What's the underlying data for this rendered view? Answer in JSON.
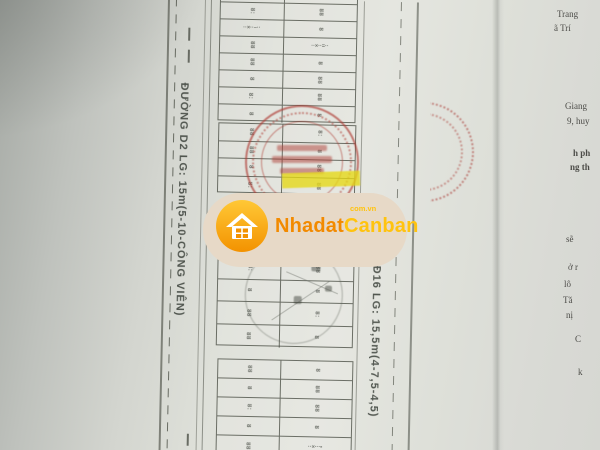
{
  "watermark": {
    "brand_part1": "Nhadat",
    "brand_part2": "Canban",
    "domain": "com.vn",
    "pill_color": "#e7d9c7",
    "orange": "#f28a00",
    "yellow": "#ffc30f"
  },
  "roads": {
    "left_label": "ĐƯỜNG D2 LG: 15m(5-10-CÔNG VIÊN)",
    "right_label": "ĐƯỜNG Đ16 LG: 15,5m(4-7,5-4,5)"
  },
  "plan": {
    "line_color": "rgba(72,76,66,0.78)",
    "marks": [
      "8",
      "88",
      "8:",
      "88",
      "8"
    ],
    "blocks": [
      {
        "left": 220,
        "top": -14,
        "width": 138,
        "rows": 8,
        "row_h": 17
      },
      {
        "left": 221,
        "top": 124,
        "width": 138,
        "rows": 4,
        "row_h": 17.5
      },
      {
        "left": 223,
        "top": 257,
        "width": 137,
        "rows": 4,
        "row_h": 22.5
      },
      {
        "left": 225,
        "top": 360,
        "width": 136,
        "rows": 5,
        "row_h": 19
      }
    ],
    "overrides": [
      {
        "b": 0,
        "r": 2,
        "c": 0,
        "t": "··×··–··"
      },
      {
        "b": 0,
        "r": 3,
        "c": 1,
        "t": "··×··=··"
      },
      {
        "b": 3,
        "r": 4,
        "c": 1,
        "t": "··×···▪"
      }
    ]
  },
  "stamps": {
    "red": "#b03e36",
    "highlight_yellow": "#e6d814"
  },
  "page2_fragments": [
    {
      "t": "Trang",
      "x": 557,
      "y": 9,
      "b": 0
    },
    {
      "t": "ã Trí",
      "x": 554,
      "y": 23,
      "b": 0
    },
    {
      "t": "Giang",
      "x": 565,
      "y": 101,
      "b": 0
    },
    {
      "t": "9, huy",
      "x": 567,
      "y": 116,
      "b": 0
    },
    {
      "t": "h ph",
      "x": 573,
      "y": 148,
      "b": 1
    },
    {
      "t": "ng th",
      "x": 570,
      "y": 162,
      "b": 1
    },
    {
      "t": "sẽ",
      "x": 566,
      "y": 234,
      "b": 0
    },
    {
      "t": "ở r",
      "x": 568,
      "y": 262,
      "b": 0
    },
    {
      "t": "lô",
      "x": 564,
      "y": 279,
      "b": 0
    },
    {
      "t": "Tă",
      "x": 563,
      "y": 295,
      "b": 0
    },
    {
      "t": "nị",
      "x": 566,
      "y": 310,
      "b": 0
    },
    {
      "t": "C",
      "x": 575,
      "y": 334,
      "b": 0
    },
    {
      "t": "k",
      "x": 578,
      "y": 367,
      "b": 0
    }
  ]
}
